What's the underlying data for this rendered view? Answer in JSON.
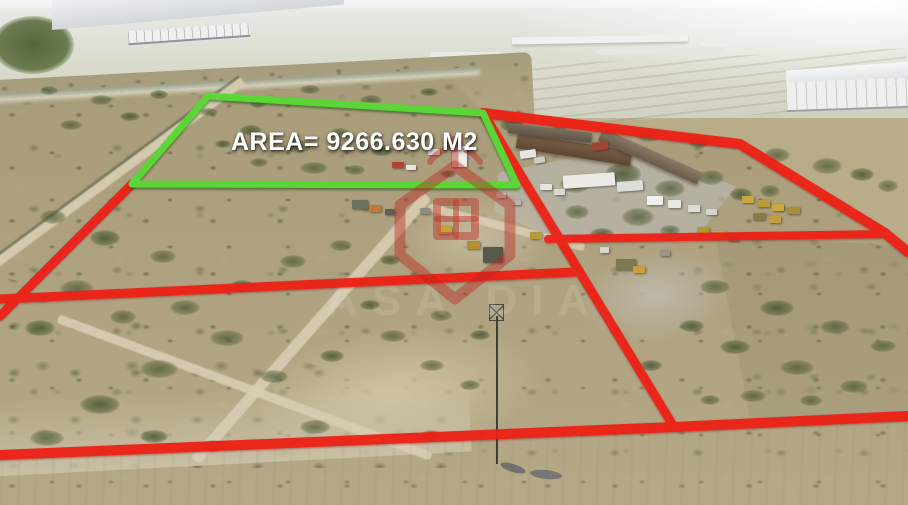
{
  "annotation": {
    "area_label": "AREA= 9266.630 M2",
    "area_value": "9266.630",
    "area_unit": "M2"
  },
  "colors": {
    "boundary_red": "#ee2015",
    "parcel_green": "#5cd637",
    "area_label_color": "#ffffff"
  },
  "overlays": {
    "green_parcel": "208,96 483,113 517,185 132,184",
    "red_left_edge": "132,184 0,316",
    "red_left_divider": "0,299 575,272",
    "red_main_diagonal": "483,113 674,427",
    "red_top_right": "483,113 740,144 885,233 908,252",
    "red_right_divider": "548,239 886,234",
    "red_bottom": "0,455 674,427 908,416"
  },
  "watermark": {
    "logo": "house-pin-logo",
    "faint_text": "ASA DIA"
  }
}
